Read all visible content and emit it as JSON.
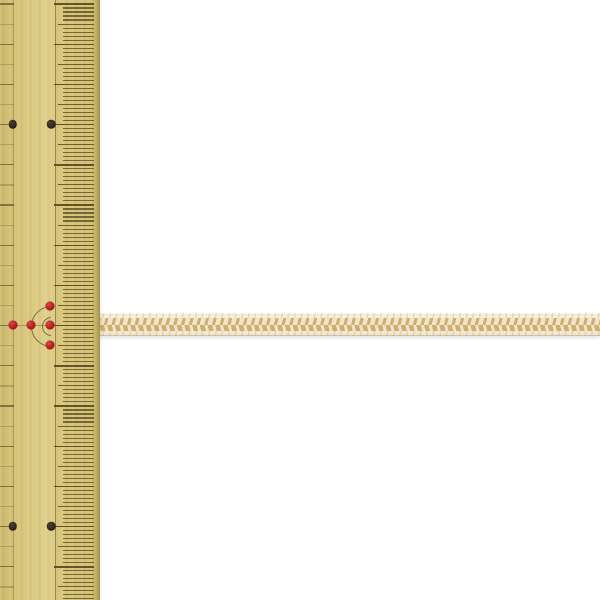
{
  "photo": {
    "kind": "product-photograph",
    "background_color": "#ffffff",
    "ruler": {
      "name": "bamboo-ruler",
      "body_color_light": "#dfd08a",
      "body_color_mid": "#d6c377",
      "body_color_dark": "#c8b668",
      "edge_color": "#a9984f",
      "edge_color_2": "#c2b065",
      "tick_color": "#51431d",
      "guide_line_color": "#6e5e30",
      "black_dot_color": "#2d2519",
      "red_dot_color": "#b5191e",
      "red_dot_highlight": "#d24a45",
      "arc_color": "#5f5030"
    },
    "cord": {
      "name": "braided-cord",
      "edge_color": "#f3edda",
      "edge_line_color": "#d9cfb4",
      "braid_dark_color": "#d0ae6f",
      "braid_light_color": "#efe5c7",
      "shadow_color": "rgba(60,45,20,0.12)"
    }
  }
}
